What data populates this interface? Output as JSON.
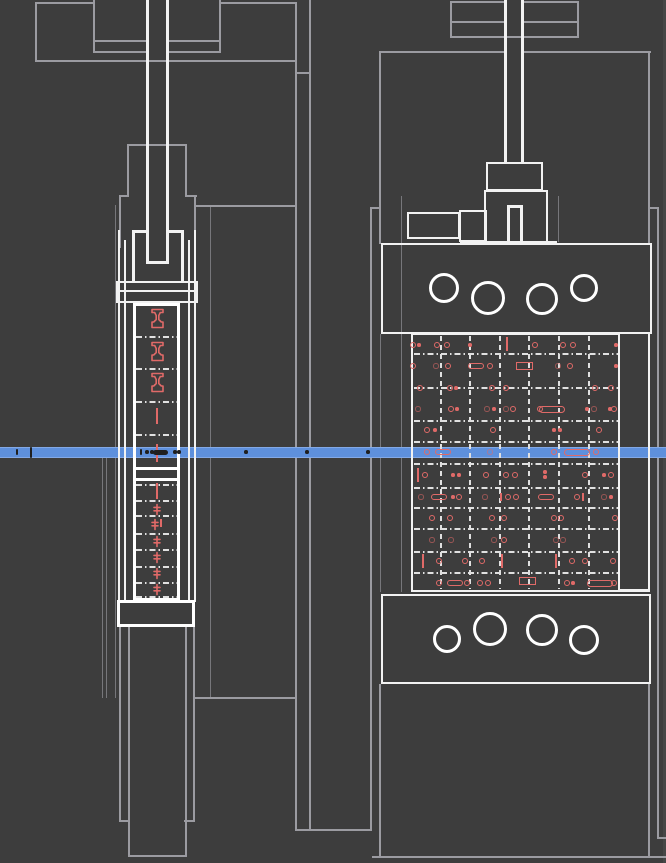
{
  "meta": {
    "description": "CAD wireframe drawing: two orthographic views of a clamp / fixture assembly with a horizontal blue section scan line",
    "views": [
      "side-view-left",
      "front-view-right"
    ]
  },
  "colors": {
    "bg": "#3d3d3d",
    "strip": "#464646",
    "gray": "#9b9ba1",
    "white": "#f2f2f2",
    "dash": "#e0e0e0",
    "red": "#e06a68",
    "dark": "#1f1f1f",
    "blue": "#5e90dc",
    "blueEdge": "#83a9e6"
  },
  "scan_line": {
    "y": 447,
    "height": 11
  },
  "drawing": {
    "gray_lines": [
      [
        35,
        2,
        58,
        2
      ],
      [
        220,
        2,
        77,
        2
      ],
      [
        35,
        2,
        2,
        60
      ],
      [
        35,
        60,
        262,
        2
      ],
      [
        93,
        0,
        2,
        53
      ],
      [
        219,
        0,
        2,
        53
      ],
      [
        93,
        40,
        53,
        2
      ],
      [
        168,
        40,
        53,
        2
      ],
      [
        93,
        51,
        53,
        2
      ],
      [
        168,
        51,
        53,
        2
      ],
      [
        295,
        2,
        2,
        829
      ],
      [
        309,
        0,
        2,
        831
      ],
      [
        295,
        72,
        16,
        2
      ],
      [
        195,
        205,
        102,
        2
      ],
      [
        195,
        697,
        102,
        2
      ],
      [
        295,
        829,
        77,
        2
      ],
      [
        127,
        144,
        60,
        2
      ],
      [
        127,
        144,
        2,
        53
      ],
      [
        185,
        144,
        2,
        53
      ],
      [
        119,
        195,
        10,
        2
      ],
      [
        185,
        195,
        12,
        2
      ],
      [
        119,
        195,
        2,
        53
      ],
      [
        194,
        195,
        2,
        53
      ],
      [
        115,
        205,
        1,
        493
      ],
      [
        210,
        205,
        1,
        493
      ],
      [
        102,
        458,
        1,
        240
      ],
      [
        106,
        458,
        1,
        240
      ],
      [
        128,
        627,
        2,
        230
      ],
      [
        185,
        627,
        2,
        230
      ],
      [
        128,
        855,
        59,
        2
      ],
      [
        119,
        627,
        2,
        195
      ],
      [
        193,
        627,
        2,
        195
      ],
      [
        119,
        820,
        11,
        2
      ],
      [
        184,
        820,
        11,
        2
      ],
      [
        379,
        51,
        128,
        2
      ],
      [
        522,
        51,
        129,
        2
      ],
      [
        379,
        51,
        2,
        193
      ],
      [
        648,
        51,
        2,
        193
      ],
      [
        370,
        207,
        2,
        624
      ],
      [
        657,
        207,
        2,
        631
      ],
      [
        370,
        207,
        11,
        2
      ],
      [
        648,
        207,
        11,
        2
      ],
      [
        401,
        196,
        1,
        396
      ],
      [
        558,
        196,
        1,
        46
      ],
      [
        657,
        837,
        9,
        2
      ],
      [
        372,
        856,
        294,
        2
      ],
      [
        379,
        684,
        2,
        174
      ],
      [
        648,
        684,
        2,
        174
      ],
      [
        380,
        334,
        1,
        258
      ],
      [
        450,
        1,
        56,
        2
      ],
      [
        522,
        1,
        57,
        2
      ],
      [
        450,
        1,
        2,
        37
      ],
      [
        577,
        1,
        2,
        37
      ],
      [
        450,
        36,
        129,
        2
      ],
      [
        450,
        21,
        56,
        2
      ],
      [
        522,
        21,
        57,
        2
      ]
    ],
    "white_lines": [
      [
        146,
        0,
        3,
        263
      ],
      [
        166,
        0,
        3,
        263
      ],
      [
        146,
        261,
        23,
        3
      ],
      [
        132,
        230,
        3,
        52
      ],
      [
        181,
        230,
        3,
        52
      ],
      [
        132,
        230,
        17,
        3
      ],
      [
        166,
        230,
        18,
        3
      ],
      [
        118,
        290,
        78,
        2
      ],
      [
        118,
        230,
        2,
        372
      ],
      [
        194,
        230,
        2,
        372
      ],
      [
        124,
        240,
        2,
        362
      ],
      [
        188,
        240,
        2,
        362
      ],
      [
        504,
        0,
        3,
        163
      ],
      [
        521,
        0,
        3,
        163
      ],
      [
        507,
        205,
        3,
        39
      ],
      [
        520,
        205,
        3,
        39
      ],
      [
        507,
        205,
        16,
        3
      ],
      [
        460,
        241,
        97,
        3
      ],
      [
        620,
        589,
        30,
        3
      ],
      [
        648,
        334,
        2,
        258
      ]
    ],
    "white_rects": [
      [
        116,
        281,
        82,
        22,
        0
      ],
      [
        133,
        303,
        47,
        298,
        1
      ],
      [
        133,
        467,
        47,
        14,
        1
      ],
      [
        117,
        600,
        78,
        27,
        1
      ],
      [
        486,
        162,
        57,
        29,
        0
      ],
      [
        484,
        190,
        64,
        54,
        0
      ],
      [
        407,
        212,
        53,
        27,
        0
      ],
      [
        459,
        210,
        28,
        32,
        0
      ],
      [
        381,
        243,
        271,
        91,
        0
      ],
      [
        411,
        333,
        209,
        259,
        0
      ],
      [
        381,
        594,
        270,
        90,
        0
      ]
    ],
    "circles": [
      [
        444,
        288,
        15
      ],
      [
        488,
        298,
        17
      ],
      [
        542,
        299,
        16
      ],
      [
        584,
        288,
        14
      ],
      [
        447,
        639,
        14
      ],
      [
        490,
        629,
        17
      ],
      [
        542,
        630,
        16
      ],
      [
        584,
        640,
        15
      ]
    ],
    "dash_rows": [
      [
        336,
        136,
        177
      ],
      [
        368,
        136,
        177
      ],
      [
        401,
        136,
        177
      ],
      [
        434,
        136,
        177
      ],
      [
        484,
        136,
        177
      ],
      [
        500,
        136,
        177
      ],
      [
        515,
        136,
        177
      ],
      [
        533,
        136,
        177
      ],
      [
        549,
        136,
        177
      ],
      [
        566,
        136,
        177
      ],
      [
        582,
        136,
        177
      ],
      [
        596,
        136,
        177
      ],
      [
        353,
        414,
        618
      ],
      [
        387,
        414,
        618
      ],
      [
        420,
        414,
        618
      ],
      [
        441,
        414,
        618
      ],
      [
        463,
        414,
        618
      ],
      [
        487,
        414,
        618
      ],
      [
        507,
        414,
        618
      ],
      [
        528,
        414,
        618
      ],
      [
        551,
        414,
        618
      ],
      [
        572,
        414,
        618
      ]
    ],
    "dash_cols": [
      [
        440,
        336,
        589
      ],
      [
        469,
        336,
        589
      ],
      [
        499,
        336,
        589
      ],
      [
        528,
        336,
        589
      ],
      [
        558,
        336,
        589
      ],
      [
        588,
        336,
        589
      ]
    ],
    "red_marks": [
      [
        413,
        345,
        "c"
      ],
      [
        419,
        345,
        "d"
      ],
      [
        437,
        345,
        "c"
      ],
      [
        447,
        345,
        "c"
      ],
      [
        470,
        345,
        "d"
      ],
      [
        507,
        344,
        "V"
      ],
      [
        535,
        345,
        "c"
      ],
      [
        563,
        345,
        "c"
      ],
      [
        573,
        345,
        "c"
      ],
      [
        616,
        345,
        "d"
      ],
      [
        413,
        366,
        "c"
      ],
      [
        436,
        366,
        "g"
      ],
      [
        448,
        366,
        "c"
      ],
      [
        476,
        366,
        "p"
      ],
      [
        490,
        366,
        "c"
      ],
      [
        524,
        366,
        "r"
      ],
      [
        558,
        366,
        "g"
      ],
      [
        570,
        366,
        "c"
      ],
      [
        616,
        366,
        "d"
      ],
      [
        420,
        388,
        "c"
      ],
      [
        450,
        388,
        "c"
      ],
      [
        456,
        388,
        "d"
      ],
      [
        492,
        388,
        "c"
      ],
      [
        506,
        388,
        "c"
      ],
      [
        595,
        388,
        "c"
      ],
      [
        611,
        388,
        "c"
      ],
      [
        418,
        409,
        "g"
      ],
      [
        451,
        409,
        "c"
      ],
      [
        457,
        409,
        "d"
      ],
      [
        487,
        409,
        "g"
      ],
      [
        494,
        409,
        "d"
      ],
      [
        506,
        409,
        "g"
      ],
      [
        513,
        409,
        "c"
      ],
      [
        540,
        409,
        "c"
      ],
      [
        552,
        409,
        "P"
      ],
      [
        587,
        409,
        "d"
      ],
      [
        594,
        409,
        "g"
      ],
      [
        610,
        409,
        "d"
      ],
      [
        614,
        409,
        "c"
      ],
      [
        427,
        430,
        "c"
      ],
      [
        435,
        430,
        "d"
      ],
      [
        493,
        430,
        "c"
      ],
      [
        554,
        430,
        "d"
      ],
      [
        560,
        430,
        "d"
      ],
      [
        599,
        430,
        "c"
      ],
      [
        427,
        452,
        "c"
      ],
      [
        443,
        452,
        "p"
      ],
      [
        490,
        452,
        "g"
      ],
      [
        554,
        452,
        "c"
      ],
      [
        577,
        452,
        "P"
      ],
      [
        596,
        452,
        "c"
      ],
      [
        418,
        475,
        "V"
      ],
      [
        425,
        475,
        "c"
      ],
      [
        453,
        475,
        "d"
      ],
      [
        459,
        475,
        "d"
      ],
      [
        486,
        475,
        "c"
      ],
      [
        506,
        475,
        "c"
      ],
      [
        515,
        475,
        "c"
      ],
      [
        545,
        472,
        "d"
      ],
      [
        545,
        477,
        "d"
      ],
      [
        585,
        475,
        "c"
      ],
      [
        604,
        475,
        "d"
      ],
      [
        611,
        475,
        "c"
      ],
      [
        421,
        497,
        "g"
      ],
      [
        439,
        497,
        "p"
      ],
      [
        453,
        497,
        "d"
      ],
      [
        459,
        497,
        "c"
      ],
      [
        485,
        497,
        "g"
      ],
      [
        501,
        497,
        "v"
      ],
      [
        508,
        497,
        "c"
      ],
      [
        516,
        497,
        "c"
      ],
      [
        546,
        497,
        "p"
      ],
      [
        577,
        497,
        "c"
      ],
      [
        583,
        497,
        "v"
      ],
      [
        604,
        497,
        "g"
      ],
      [
        611,
        497,
        "d"
      ],
      [
        432,
        518,
        "c"
      ],
      [
        450,
        518,
        "c"
      ],
      [
        492,
        518,
        "c"
      ],
      [
        504,
        518,
        "c"
      ],
      [
        554,
        518,
        "c"
      ],
      [
        561,
        518,
        "c"
      ],
      [
        615,
        518,
        "c"
      ],
      [
        432,
        540,
        "g"
      ],
      [
        451,
        540,
        "g"
      ],
      [
        494,
        540,
        "g"
      ],
      [
        504,
        540,
        "c"
      ],
      [
        556,
        540,
        "g"
      ],
      [
        563,
        540,
        "g"
      ],
      [
        423,
        561,
        "V"
      ],
      [
        439,
        561,
        "c"
      ],
      [
        465,
        561,
        "c"
      ],
      [
        482,
        561,
        "c"
      ],
      [
        502,
        561,
        "V"
      ],
      [
        556,
        561,
        "V"
      ],
      [
        572,
        561,
        "c"
      ],
      [
        585,
        561,
        "c"
      ],
      [
        613,
        561,
        "c"
      ],
      [
        439,
        583,
        "c"
      ],
      [
        455,
        583,
        "p"
      ],
      [
        467,
        583,
        "c"
      ],
      [
        480,
        583,
        "c"
      ],
      [
        488,
        583,
        "c"
      ],
      [
        527,
        581,
        "r"
      ],
      [
        567,
        583,
        "c"
      ],
      [
        573,
        583,
        "d"
      ],
      [
        600,
        583,
        "P"
      ],
      [
        614,
        583,
        "c"
      ],
      [
        157,
        318,
        "I"
      ],
      [
        157,
        351,
        "I"
      ],
      [
        157,
        382,
        "I"
      ],
      [
        157,
        416,
        "V2"
      ],
      [
        157,
        453,
        "V3"
      ],
      [
        157,
        491,
        "V2"
      ],
      [
        157,
        509,
        "b"
      ],
      [
        155,
        524,
        "b"
      ],
      [
        161,
        523,
        "v"
      ],
      [
        157,
        541,
        "b"
      ],
      [
        157,
        557,
        "b"
      ],
      [
        157,
        573,
        "b"
      ],
      [
        157,
        589,
        "b"
      ]
    ],
    "dark_marks": [
      [
        17,
        452,
        "t"
      ],
      [
        31,
        452,
        "T"
      ],
      [
        141,
        452,
        "t"
      ],
      [
        147,
        452,
        "d"
      ],
      [
        152,
        452,
        "d"
      ],
      [
        160,
        452,
        "P"
      ],
      [
        175,
        452,
        "d"
      ],
      [
        179,
        452,
        "d"
      ],
      [
        246,
        452,
        "d"
      ],
      [
        307,
        452,
        "d"
      ],
      [
        368,
        452,
        "d"
      ]
    ]
  }
}
